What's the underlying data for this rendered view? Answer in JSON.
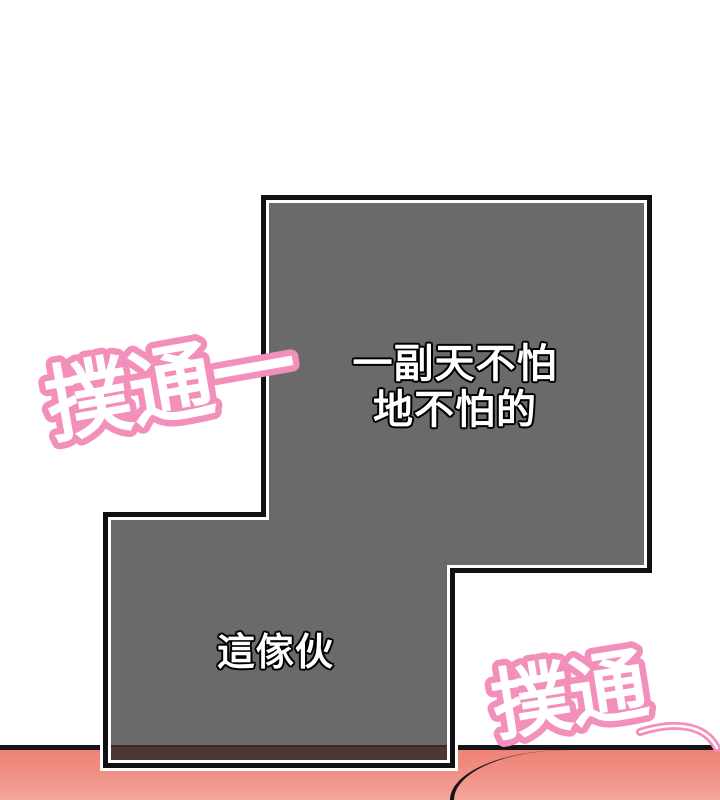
{
  "panel": {
    "dialogue_top": {
      "line1": "一副天不怕",
      "line2": "地不怕的"
    },
    "dialogue_bottom": "這傢伙"
  },
  "sfx": {
    "top_left": "撲通一",
    "bottom_right": "撲通"
  },
  "colors": {
    "background": "#ffffff",
    "panel_fill": "#6a6a6a",
    "panel_border": "#111111",
    "panel_inner_stroke": "#ffffff",
    "dialogue_text": "#ffffff",
    "dialogue_outline": "#000000",
    "sfx_pink": "#f28fba",
    "sfx_core": "#ffffff",
    "floor_pink_top": "#ee8176",
    "floor_pink_bottom": "#f5a69b",
    "floor_line": "#141414",
    "table_edge_brown": "#4b3836",
    "hair_cream": "#f5eed8",
    "hair_yellow": "#f0d67c",
    "hair_tan": "#c08c59",
    "hair_brown": "#6b4422",
    "hair_outline": "#151515"
  }
}
